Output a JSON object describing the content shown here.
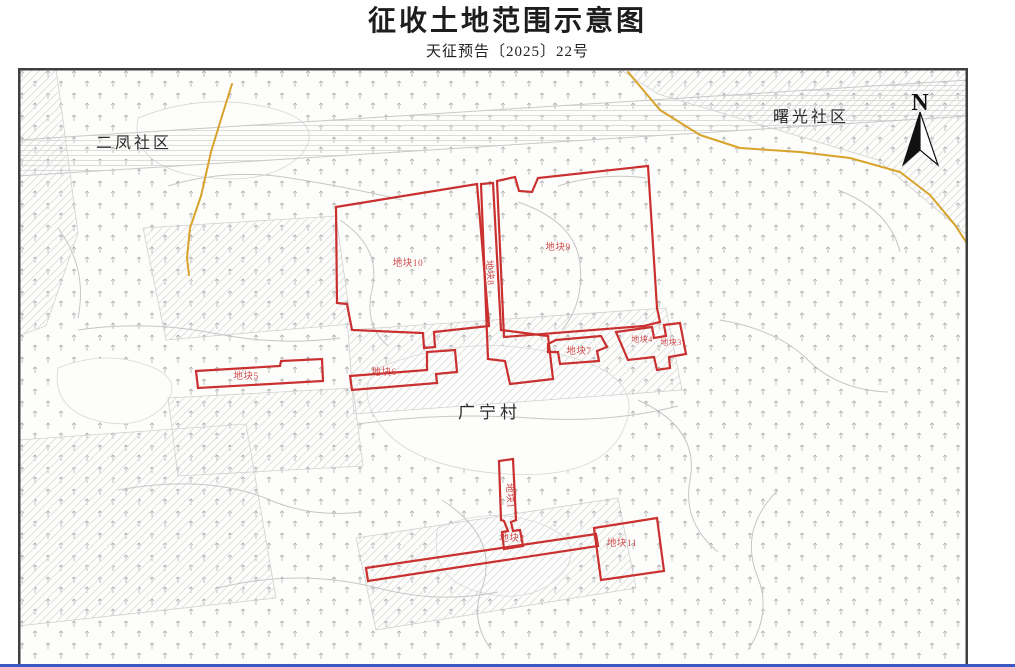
{
  "title": "征收土地范围示意图",
  "subtitle": "天征预告〔2025〕22号",
  "map": {
    "regions": {
      "top_left_community": "二凤社区",
      "top_right_community": "曙光社区",
      "center_village": "广宁村"
    },
    "north_arrow_label": "N",
    "parcels": [
      {
        "label": "地块1"
      },
      {
        "label": "地块2"
      },
      {
        "label": "地块3"
      },
      {
        "label": "地块4"
      },
      {
        "label": "地块5"
      },
      {
        "label": "地块6"
      },
      {
        "label": "地块7"
      },
      {
        "label": "地块8"
      },
      {
        "label": "地块9"
      },
      {
        "label": "地块10"
      },
      {
        "label": "地块11"
      }
    ],
    "colors": {
      "parcel_outline": "#c9302f",
      "parcel_label": "#cf4a4a",
      "road_yellow": "#d8a32a",
      "boundary_gray": "#c6c6c6",
      "frame": "#3f3f3f",
      "bottom_line_blue": "#3a57c4"
    }
  }
}
